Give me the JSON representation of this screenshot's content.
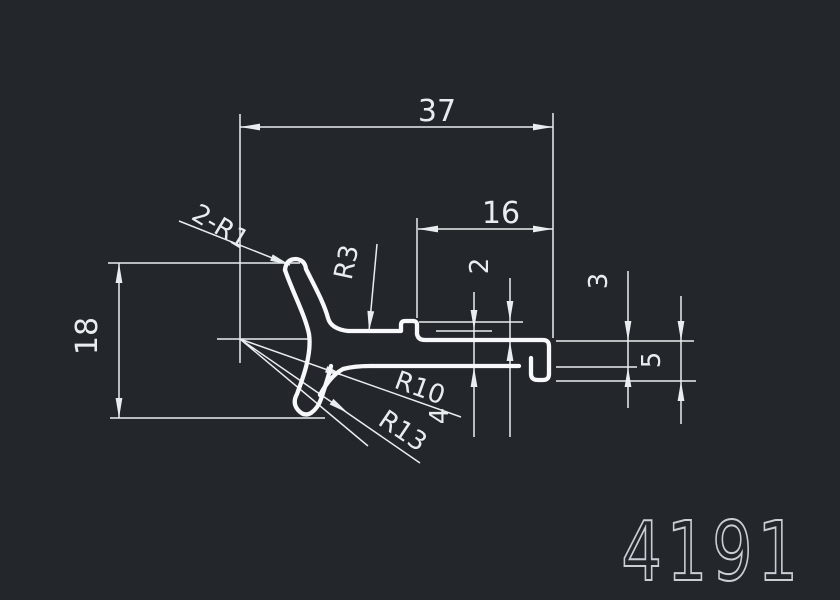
{
  "drawing": {
    "part_number": "4191",
    "colors": {
      "background": "#23272c",
      "lines": "#e9edf0",
      "profile": "#f6f8f9",
      "part_number_text": "#c9ced4"
    },
    "dimensions": {
      "overall_width": "37",
      "top_slot_length": "16",
      "overall_height": "18",
      "step_height": "2",
      "arm_thickness_right": "3",
      "arm_thickness_left": "4",
      "hook_depth": "5"
    },
    "radius_labels": {
      "tip_radii": "2-R1",
      "top_fillet": "R3",
      "inner_arc": "R10",
      "outer_arc": "R13"
    }
  }
}
